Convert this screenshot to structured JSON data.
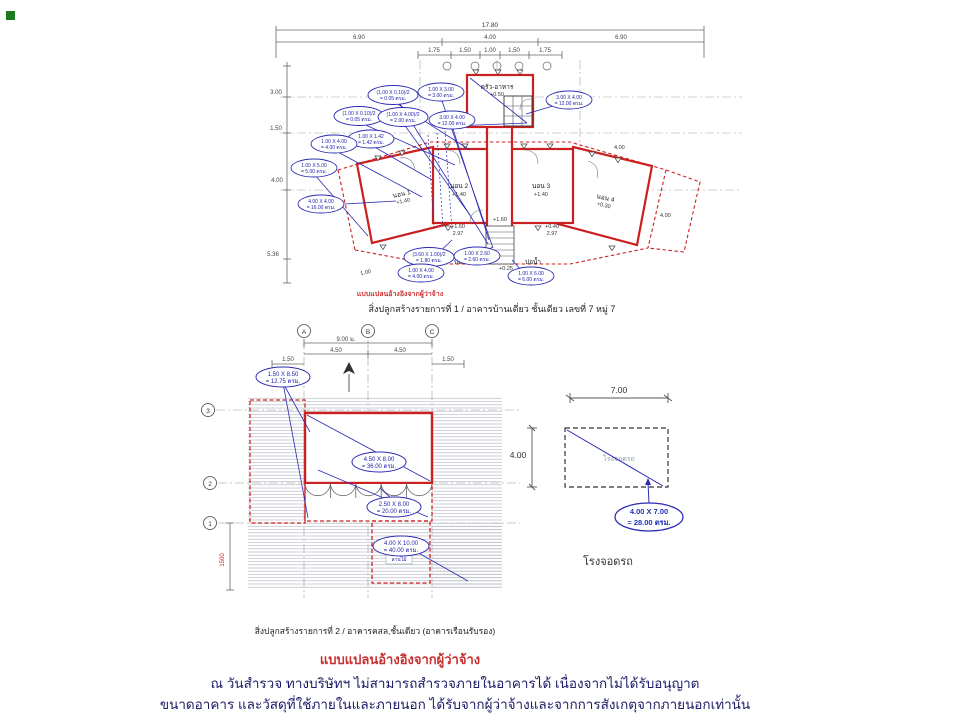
{
  "notes": {
    "heading": "แบบแปลนอ้างอิงจากผู้ว่าจ้าง",
    "line1": "ณ วันสำรวจ ทางบริษัทฯ ไม่สามารถสำรวจภายในอาคารได้ เนื่องจากไม่ได้รับอนุญาต",
    "line2": "ขนาดอาคาร และวัสดุที่ใช้ภายในและภายนอก ได้รับจากผู้ว่าจ้างและจากการสังเกตุจากภายนอกเท่านั้น"
  },
  "plan1": {
    "caption": "สิ่งปลูกสร้างรายการที่ 1 / อาคารบ้านเดี่ยว ชั้นเดียว เลขที่ 7 หมู่ 7",
    "ref_note": "แบบแปลนอ้างอิงจากผู้ว่าจ้าง",
    "dims": {
      "total": "17.80",
      "spans": [
        "6.90",
        "4.00",
        "6.90"
      ],
      "sub": [
        "1.75",
        "1.50",
        "1.00",
        "1.50",
        "1.75"
      ],
      "left": [
        "3.00",
        "1.50",
        "4.00",
        "5.36"
      ],
      "kitchen_side": "1.50",
      "wing_top": "4.00",
      "wing_side": "4.00",
      "diag": "1.00"
    },
    "rooms": {
      "kitchen_name": "ครัว-อาหาร",
      "kitchen_level": "+0.50",
      "bed1": "นอน 1",
      "bed1_level": "+1.40",
      "bed2": "นอน 2",
      "bed2_level": "+1.40",
      "bed3": "นอน 3",
      "bed3_level": "+1.40",
      "bed4": "นอน 4",
      "bed4_level": "+0.30",
      "well_left": "บ่อน้ำ",
      "well_right": "บ่อน้ำ"
    },
    "marks": {
      "m1": "+1.60",
      "m2": "2.97",
      "m3": "+1.60",
      "m4": "+0.40",
      "m5": "2.97",
      "m6": "+0.25"
    },
    "ovals": [
      {
        "s": "(1.00 X 0.10)/2",
        "a": "= 0.05 ตรม."
      },
      {
        "s": "1.00 X 3.00",
        "a": "= 3.00 ตรม."
      },
      {
        "s": "(1.00 X 0.10)/2",
        "a": "= 0.05 ตรม."
      },
      {
        "s": "(1.00 X 4.00)/2",
        "a": "= 2.00 ตรม."
      },
      {
        "s": "3.00 X 4.00",
        "a": "= 12.00 ตรม."
      },
      {
        "s": "3.00 X 4.00",
        "a": "= 12.00 ตรม."
      },
      {
        "s": "1.00 X 1.42",
        "a": "= 1.42 ตรม."
      },
      {
        "s": "1.00 X 4.00",
        "a": "= 4.00 ตรม."
      },
      {
        "s": "1.00 X 5.00",
        "a": "= 5.00 ตรม."
      },
      {
        "s": "4.00 X 4.00",
        "a": "= 16.00 ตรม."
      },
      {
        "s": "(3.60 X 1.00)/2",
        "a": "= 1.80 ตรม."
      },
      {
        "s": "1.00 X 2.60",
        "a": "= 2.60 ตรม."
      },
      {
        "s": "1.00 X 4.00",
        "a": "= 4.00 ตรม."
      },
      {
        "s": "1.00 X 6.00",
        "a": "= 6.00 ตรม."
      }
    ]
  },
  "plan2": {
    "caption": "สิ่งปลูกสร้างรายการที่ 2 / อาคารคสล,ชั้นเดียว (อาคารเรือนรับรอง)",
    "grid_top": [
      "A",
      "B",
      "C"
    ],
    "grid_left": [
      "3",
      "2",
      "1"
    ],
    "dims": {
      "total": "9.00 ม.",
      "half1": "4.50",
      "half2": "4.50",
      "edge1": "1.50",
      "edge2": "1.50",
      "red_len": "1500"
    },
    "deck_label": "ลานไม้",
    "ovals": [
      {
        "s": "1.50 X 8.50",
        "a": "= 12.75 ตรม."
      },
      {
        "s": "4.50 X 8.00",
        "a": "= 36.00 ตรม."
      },
      {
        "s": "2.50 X 8.00",
        "a": "= 20.00 ตรม."
      },
      {
        "s": "4.00 X 10.00",
        "a": "= 40.00 ตรม."
      }
    ]
  },
  "garage": {
    "caption": "โรงจอดรถ",
    "label": "โรงจอดรถ",
    "dim_w": "7.00",
    "dim_h": "4.00",
    "oval": {
      "s": "4.00 X 7.00",
      "a": "= 28.00 ตรม."
    }
  }
}
